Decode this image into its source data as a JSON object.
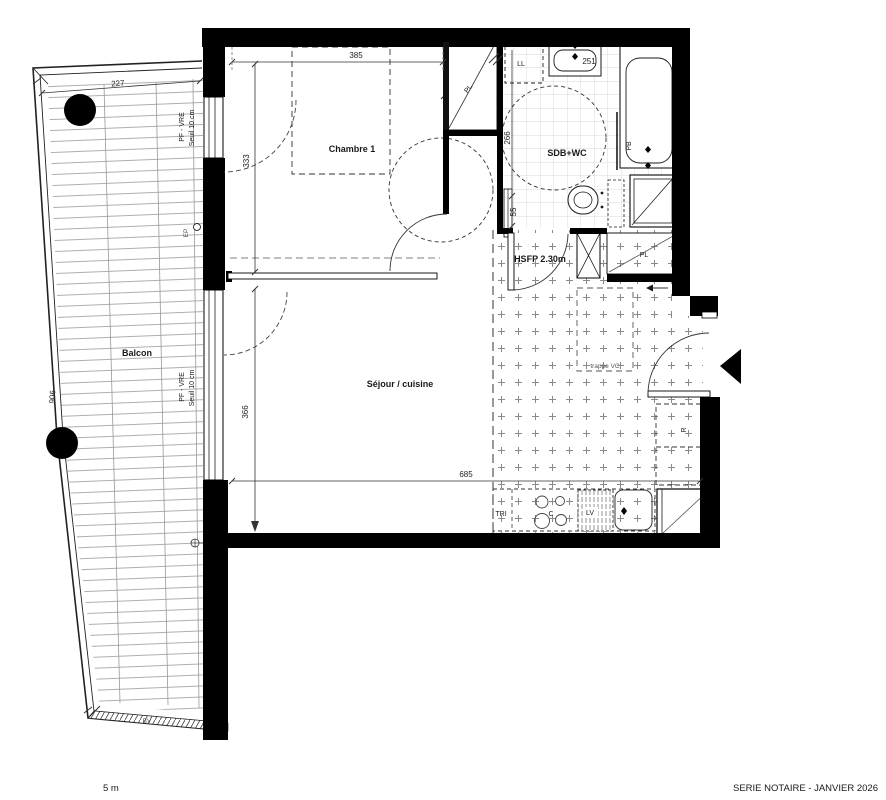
{
  "rooms": {
    "chambre": "Chambre 1",
    "sdb": "SDB+WC",
    "sejour": "Séjour / cuisine",
    "balcon": "Balcon"
  },
  "labels": {
    "hsfp": "HSFP 2.30m",
    "trappe_vc": "trappe VC",
    "pf_vre": "PF - VRE",
    "seuil": "Seuil 10 cm",
    "ep": "EP",
    "bv": "BV",
    "ll": "LL",
    "pb": "PB",
    "pl": "PL",
    "tri": "TRI",
    "cooktop": "C",
    "dishwasher": "LV",
    "fridge": "R"
  },
  "dimensions": {
    "d227": "227",
    "d385": "385",
    "d333": "333",
    "d366": "366",
    "d685": "685",
    "d906": "906",
    "d251": "251",
    "d266": "266",
    "d55": "55"
  },
  "footer": {
    "scale": "5 m",
    "series": "SERIE NOTAIRE - JANVIER 2026"
  },
  "colors": {
    "wall": "#000000",
    "line": "#1a1a1a",
    "pattern": "#888888"
  }
}
